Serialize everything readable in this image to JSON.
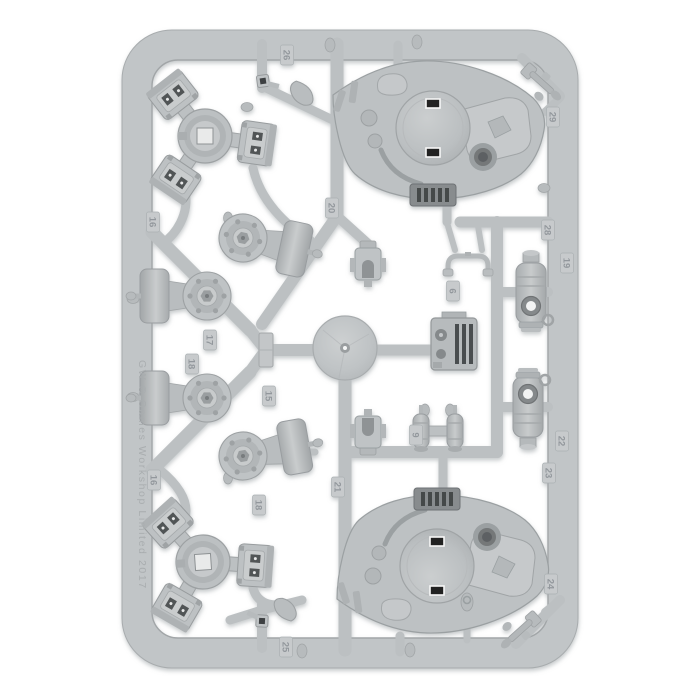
{
  "scene": {
    "description": "Photograph of a light grey injection-moulded plastic sprue (model kit frame) filled with vehicle parts, on a plain white background",
    "background_color": "#ffffff"
  },
  "sprue": {
    "copyright_text": "GW © Games Workshop Limited 2017",
    "colors": {
      "plastic_base": "#bfc3c5",
      "plastic_light": "#ced1d2",
      "plastic_shade": "#9ea3a5",
      "plastic_dark": "#8b9092",
      "slot_dark": "#1e1f20",
      "slot_rim": "#f7f7f7",
      "radiator_dark": "#45484a",
      "label_text": "#90959a"
    },
    "part_labels": [
      {
        "text": "26",
        "x": 287,
        "y": 55
      },
      {
        "text": "20",
        "x": 332,
        "y": 208
      },
      {
        "text": "16",
        "x": 153,
        "y": 222
      },
      {
        "text": "17",
        "x": 210,
        "y": 340
      },
      {
        "text": "18",
        "x": 192,
        "y": 364
      },
      {
        "text": "15",
        "x": 269,
        "y": 396
      },
      {
        "text": "16",
        "x": 154,
        "y": 480
      },
      {
        "text": "18",
        "x": 259,
        "y": 505
      },
      {
        "text": "21",
        "x": 338,
        "y": 487
      },
      {
        "text": "25",
        "x": 286,
        "y": 647
      },
      {
        "text": "29",
        "x": 553,
        "y": 117
      },
      {
        "text": "28",
        "x": 548,
        "y": 230
      },
      {
        "text": "19",
        "x": 567,
        "y": 263
      },
      {
        "text": "6",
        "x": 453,
        "y": 291
      },
      {
        "text": "9",
        "x": 416,
        "y": 435
      },
      {
        "text": "22",
        "x": 562,
        "y": 441
      },
      {
        "text": "23",
        "x": 549,
        "y": 473
      },
      {
        "text": "24",
        "x": 551,
        "y": 584
      }
    ],
    "parts_inventory": [
      "tri-clamp-hub x2",
      "turret-top-plate x2",
      "drum-and-roller-wheel x4",
      "large-flat-disc",
      "engine-block-with-grille",
      "fuel-tank-cylinder x2",
      "twin-cylinder-pack",
      "arched-mount-bracket x2",
      "grab-rail-handle",
      "antenna-stub x2",
      "square-post x2",
      "assorted-small-fittings"
    ]
  }
}
